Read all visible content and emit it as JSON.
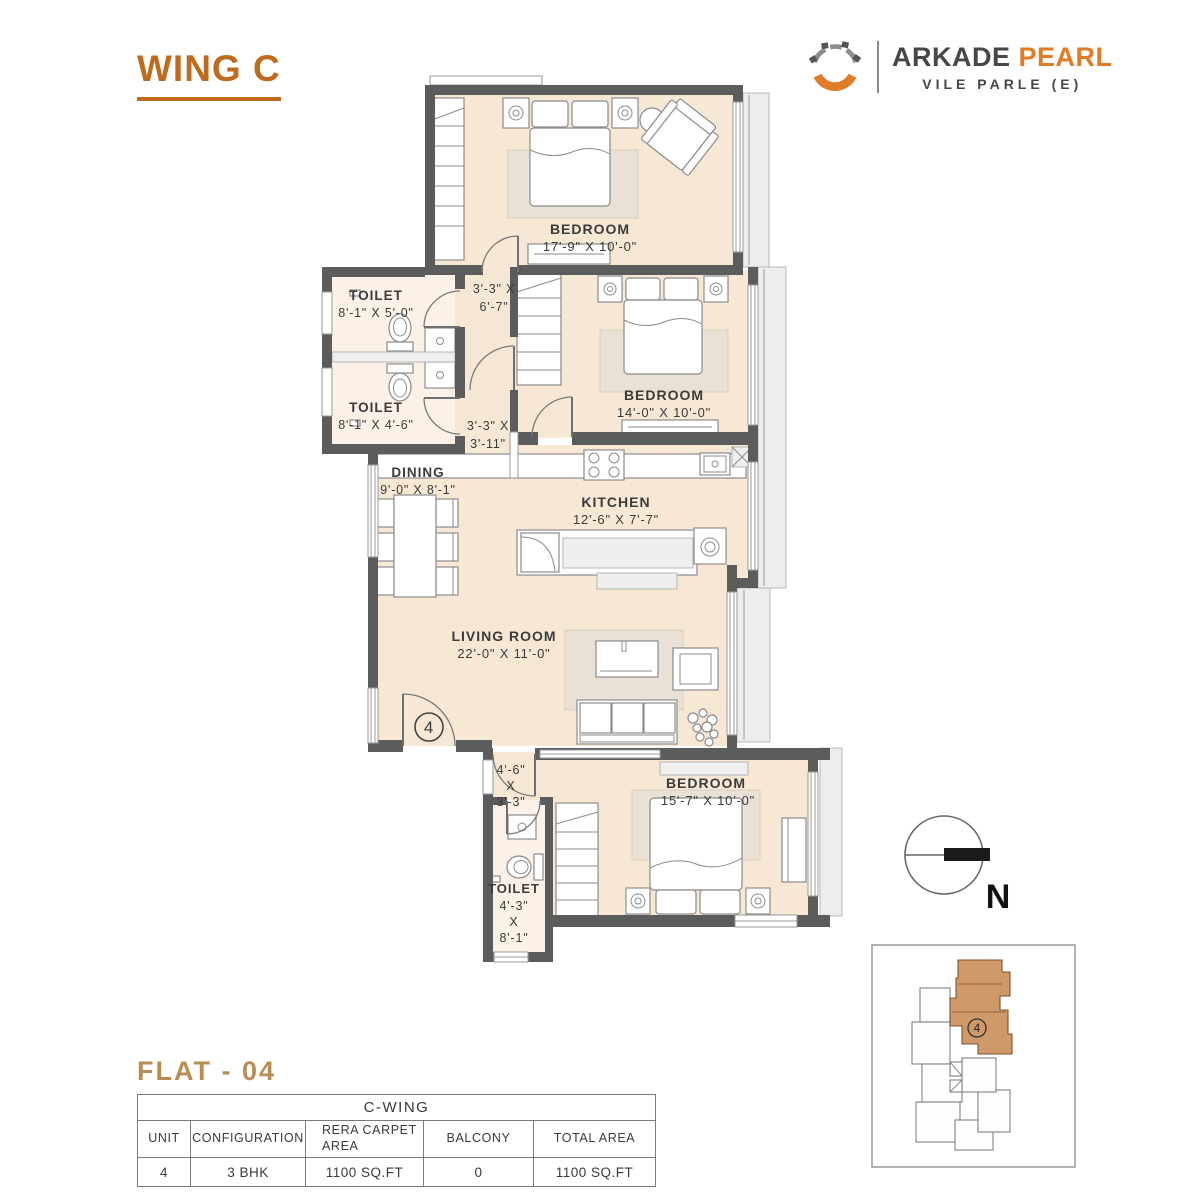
{
  "header": {
    "wing_title": "WING C",
    "brand": {
      "primary": "ARKADE",
      "secondary": "PEARL",
      "location": "VILE PARLE (E)"
    }
  },
  "plan": {
    "bedroom1": {
      "label": "BEDROOM",
      "dims": "17'-9\" X 10'-0\""
    },
    "bedroom2": {
      "label": "BEDROOM",
      "dims": "14'-0\" X 10'-0\""
    },
    "bedroom3": {
      "label": "BEDROOM",
      "dims": "15'-7\" X 10'-0\""
    },
    "toilet1": {
      "label": "TOILET",
      "dims": "8'-1\" X 5'-0\""
    },
    "toilet2": {
      "label": "TOILET",
      "dims": "8'-1\" X 4'-6\""
    },
    "toilet3": {
      "label": "TOILET",
      "d1": "4'-3\"",
      "d2": "X",
      "d3": "8'-1\""
    },
    "dining": {
      "label": "DINING",
      "dims": "9'-0\" X 8'-1\""
    },
    "kitchen": {
      "label": "KITCHEN",
      "dims": "12'-6\" X 7'-7\""
    },
    "living": {
      "label": "LIVING ROOM",
      "dims": "22'-0\" X 11'-0\""
    },
    "passage_top": {
      "l1": "3'-3\" X",
      "l2": "6'-7\""
    },
    "passage_mid": {
      "l1": "3'-3\" X",
      "l2": "3'-11\""
    },
    "passage_bottom": {
      "l1": "4'-6\"",
      "l2": "X",
      "l3": "3'-3\""
    },
    "entrance_unit_number": "4"
  },
  "compass": {
    "north_label": "N"
  },
  "keyplan": {
    "unit_number": "4"
  },
  "footer": {
    "flat_title": "FLAT - 04",
    "table": {
      "wing_header": "C-WING",
      "columns": [
        "UNIT",
        "CONFIGURATION",
        "RERA CARPET AREA",
        "BALCONY",
        "TOTAL AREA"
      ],
      "row": [
        "4",
        "3 BHK",
        "1100 SQ.FT",
        "0",
        "1100 SQ.FT"
      ]
    }
  },
  "colors": {
    "accent_orange": "#e07b26",
    "wing_title": "#bf6a1d",
    "flat_title": "#b98c54",
    "wall": "#5c5c5c",
    "floor": "#f7e8d5",
    "toilet_floor": "#fbf1e6",
    "highlight_unit": "#cf9869",
    "brand_dark": "#474747"
  }
}
